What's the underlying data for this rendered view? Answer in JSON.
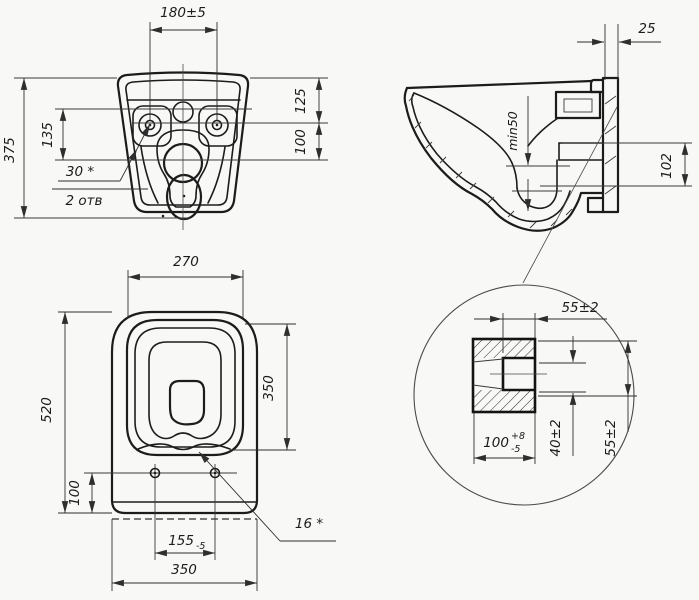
{
  "document": {
    "kind": "technical-drawing",
    "subject": "wall-hung toilet dimensional drawing, three views plus section detail"
  },
  "colors": {
    "background": "#f8f8f6",
    "outline": "#1c1c1c",
    "dimension_line": "#2e2e2e",
    "text": "#1c1c1c"
  },
  "views": {
    "rear": {
      "dims": {
        "hole_spacing": "180±5",
        "overall_height": "375",
        "left_height": "135",
        "top_to_hole_axis": "125",
        "hole_axis_to_drain_axis": "100",
        "hole_note": "30 *",
        "hole_count_note": "2 отв"
      }
    },
    "side": {
      "dims": {
        "wall_gap": "25",
        "water_seal_depth": "min50",
        "outlet_axis_height": "102"
      }
    },
    "plan": {
      "dims": {
        "seat_opening_width": "270",
        "overall_length": "520",
        "seat_opening_length": "350",
        "hole_axis_offset": "100",
        "seat_hole_spacing_base": "155",
        "seat_hole_spacing_tol": "-5",
        "overall_width": "350",
        "seat_hole_note": "16 *"
      }
    },
    "detail": {
      "dims": {
        "boss_depth": "55±2",
        "bore_base": "100",
        "bore_tol_upper": "+8",
        "bore_tol_lower": "-5",
        "inner_height": "40±2",
        "outer_height": "55±2"
      }
    }
  }
}
